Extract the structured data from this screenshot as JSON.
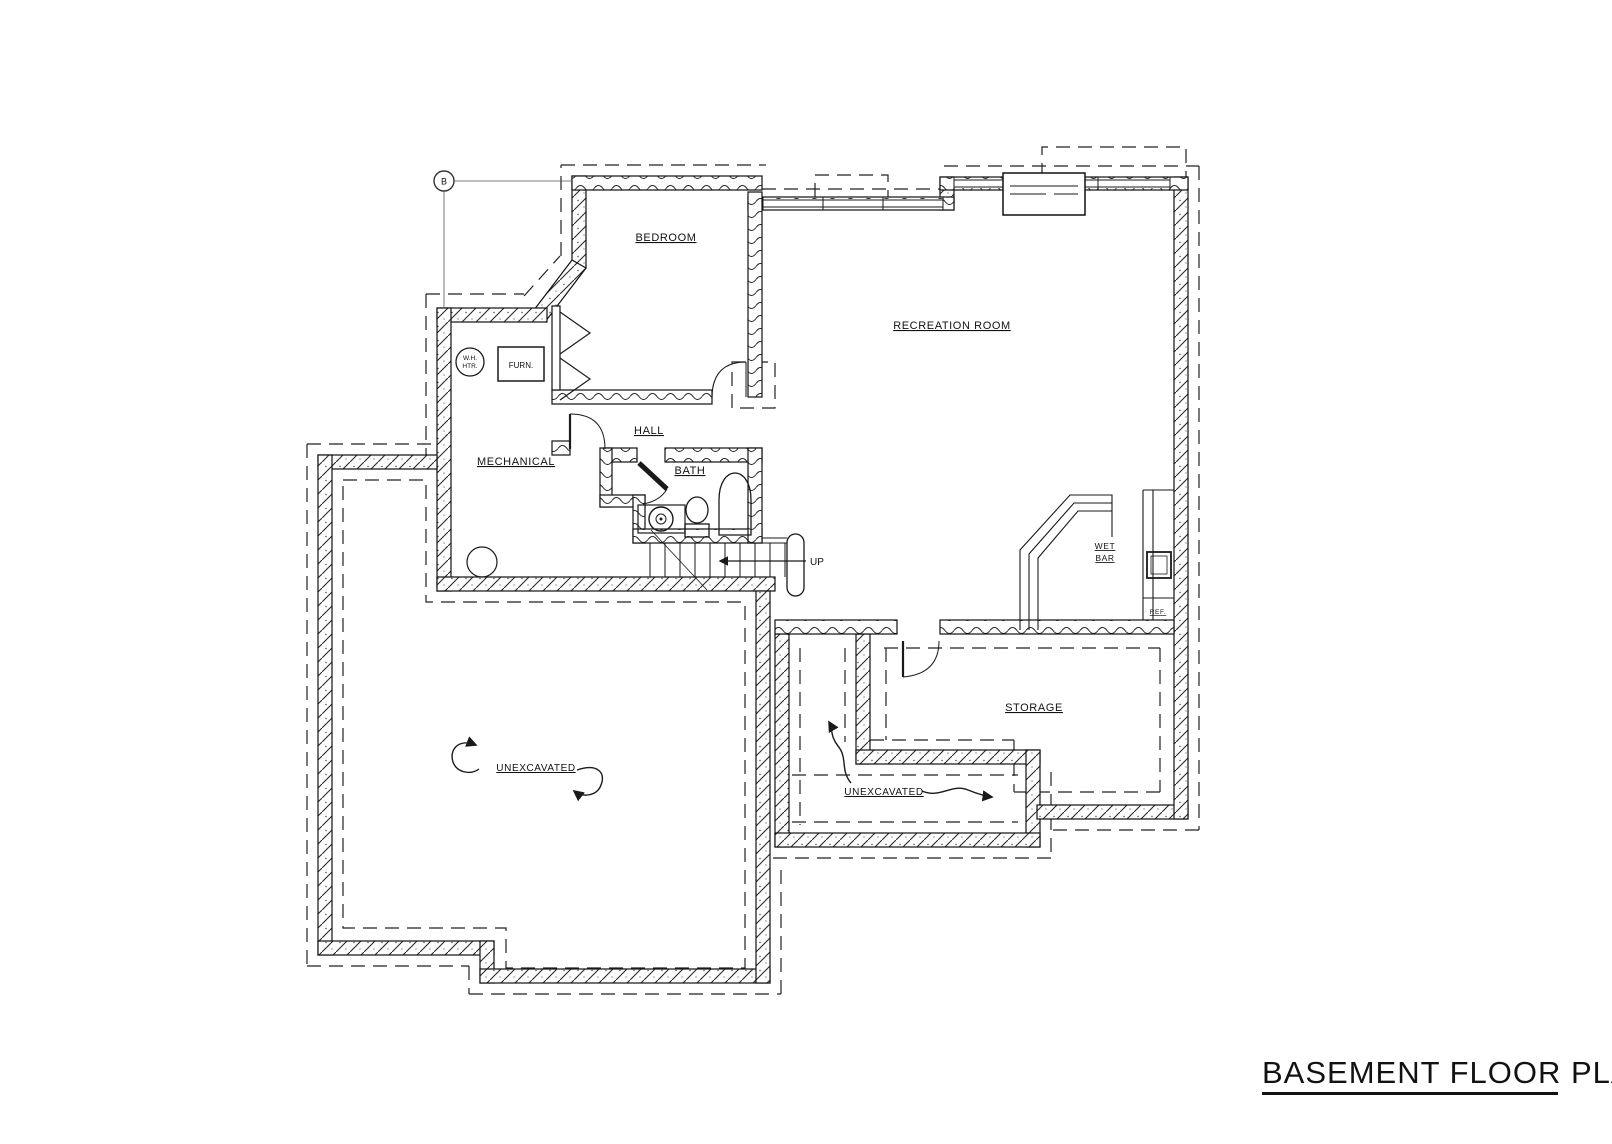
{
  "drawing": {
    "title": "BASEMENT FLOOR PLAN",
    "reference_marker": "B",
    "rooms": {
      "bedroom": "BEDROOM",
      "recreation_room": "RECREATION ROOM",
      "mechanical": "MECHANICAL",
      "hall": "HALL",
      "bath": "BATH",
      "storage": "STORAGE",
      "wet_bar_line1": "WET",
      "wet_bar_line2": "BAR",
      "unexcavated_left": "UNEXCAVATED",
      "unexcavated_right": "UNEXCAVATED"
    },
    "fixtures": {
      "furnace": "FURN.",
      "water_heater_line1": "W.H.",
      "water_heater_line2": "HTR.",
      "refrigerator": "REF.",
      "stair_direction": "UP"
    }
  }
}
